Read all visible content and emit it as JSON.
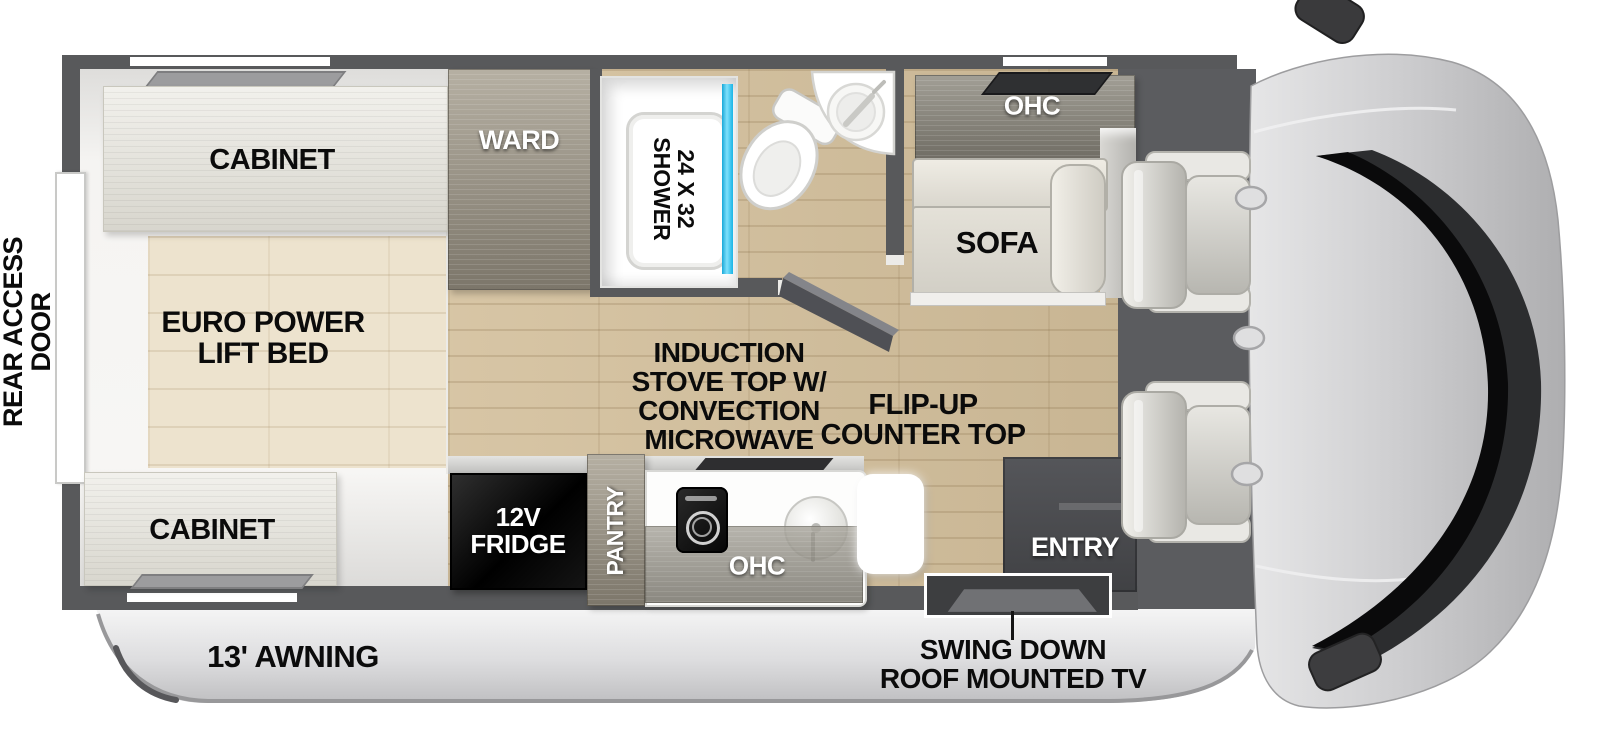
{
  "labels": {
    "rear_access_door": "REAR ACCESS\nDOOR",
    "cabinet_rear": "CABINET",
    "euro_power_lift_bed": "EURO POWER\nLIFT BED",
    "cabinet_front": "CABINET",
    "ward": "WARD",
    "shower": "24 X 32\nSHOWER",
    "ohc_rear": "OHC",
    "sofa": "SOFA",
    "induction_stove": "INDUCTION\nSTOVE TOP W/\nCONVECTION\nMICROWAVE",
    "flip_up_counter": "FLIP-UP\nCOUNTER TOP",
    "fridge_12v": "12V\nFRIDGE",
    "pantry": "PANTRY",
    "ohc_kitchen": "OHC",
    "entry": "ENTRY",
    "swing_down_tv": "SWING DOWN\nROOF MOUNTED TV",
    "awning": "13' AWNING"
  },
  "colors": {
    "wall_gray": "#58595b",
    "main_floor_wood": "#d3bf9b",
    "bedroom_floor_wood": "#ede3ce",
    "cabinet_wood": "#e5e3da",
    "dark_wood": "#8d877a",
    "shower_glass_blue": "#2bc3f0",
    "fridge_black": "#0a0a0a",
    "entry_gray": "#4a4b4d",
    "windshield_black": "#0a0a0b",
    "label_black": "#0b0b0b",
    "label_white": "#ffffff"
  }
}
